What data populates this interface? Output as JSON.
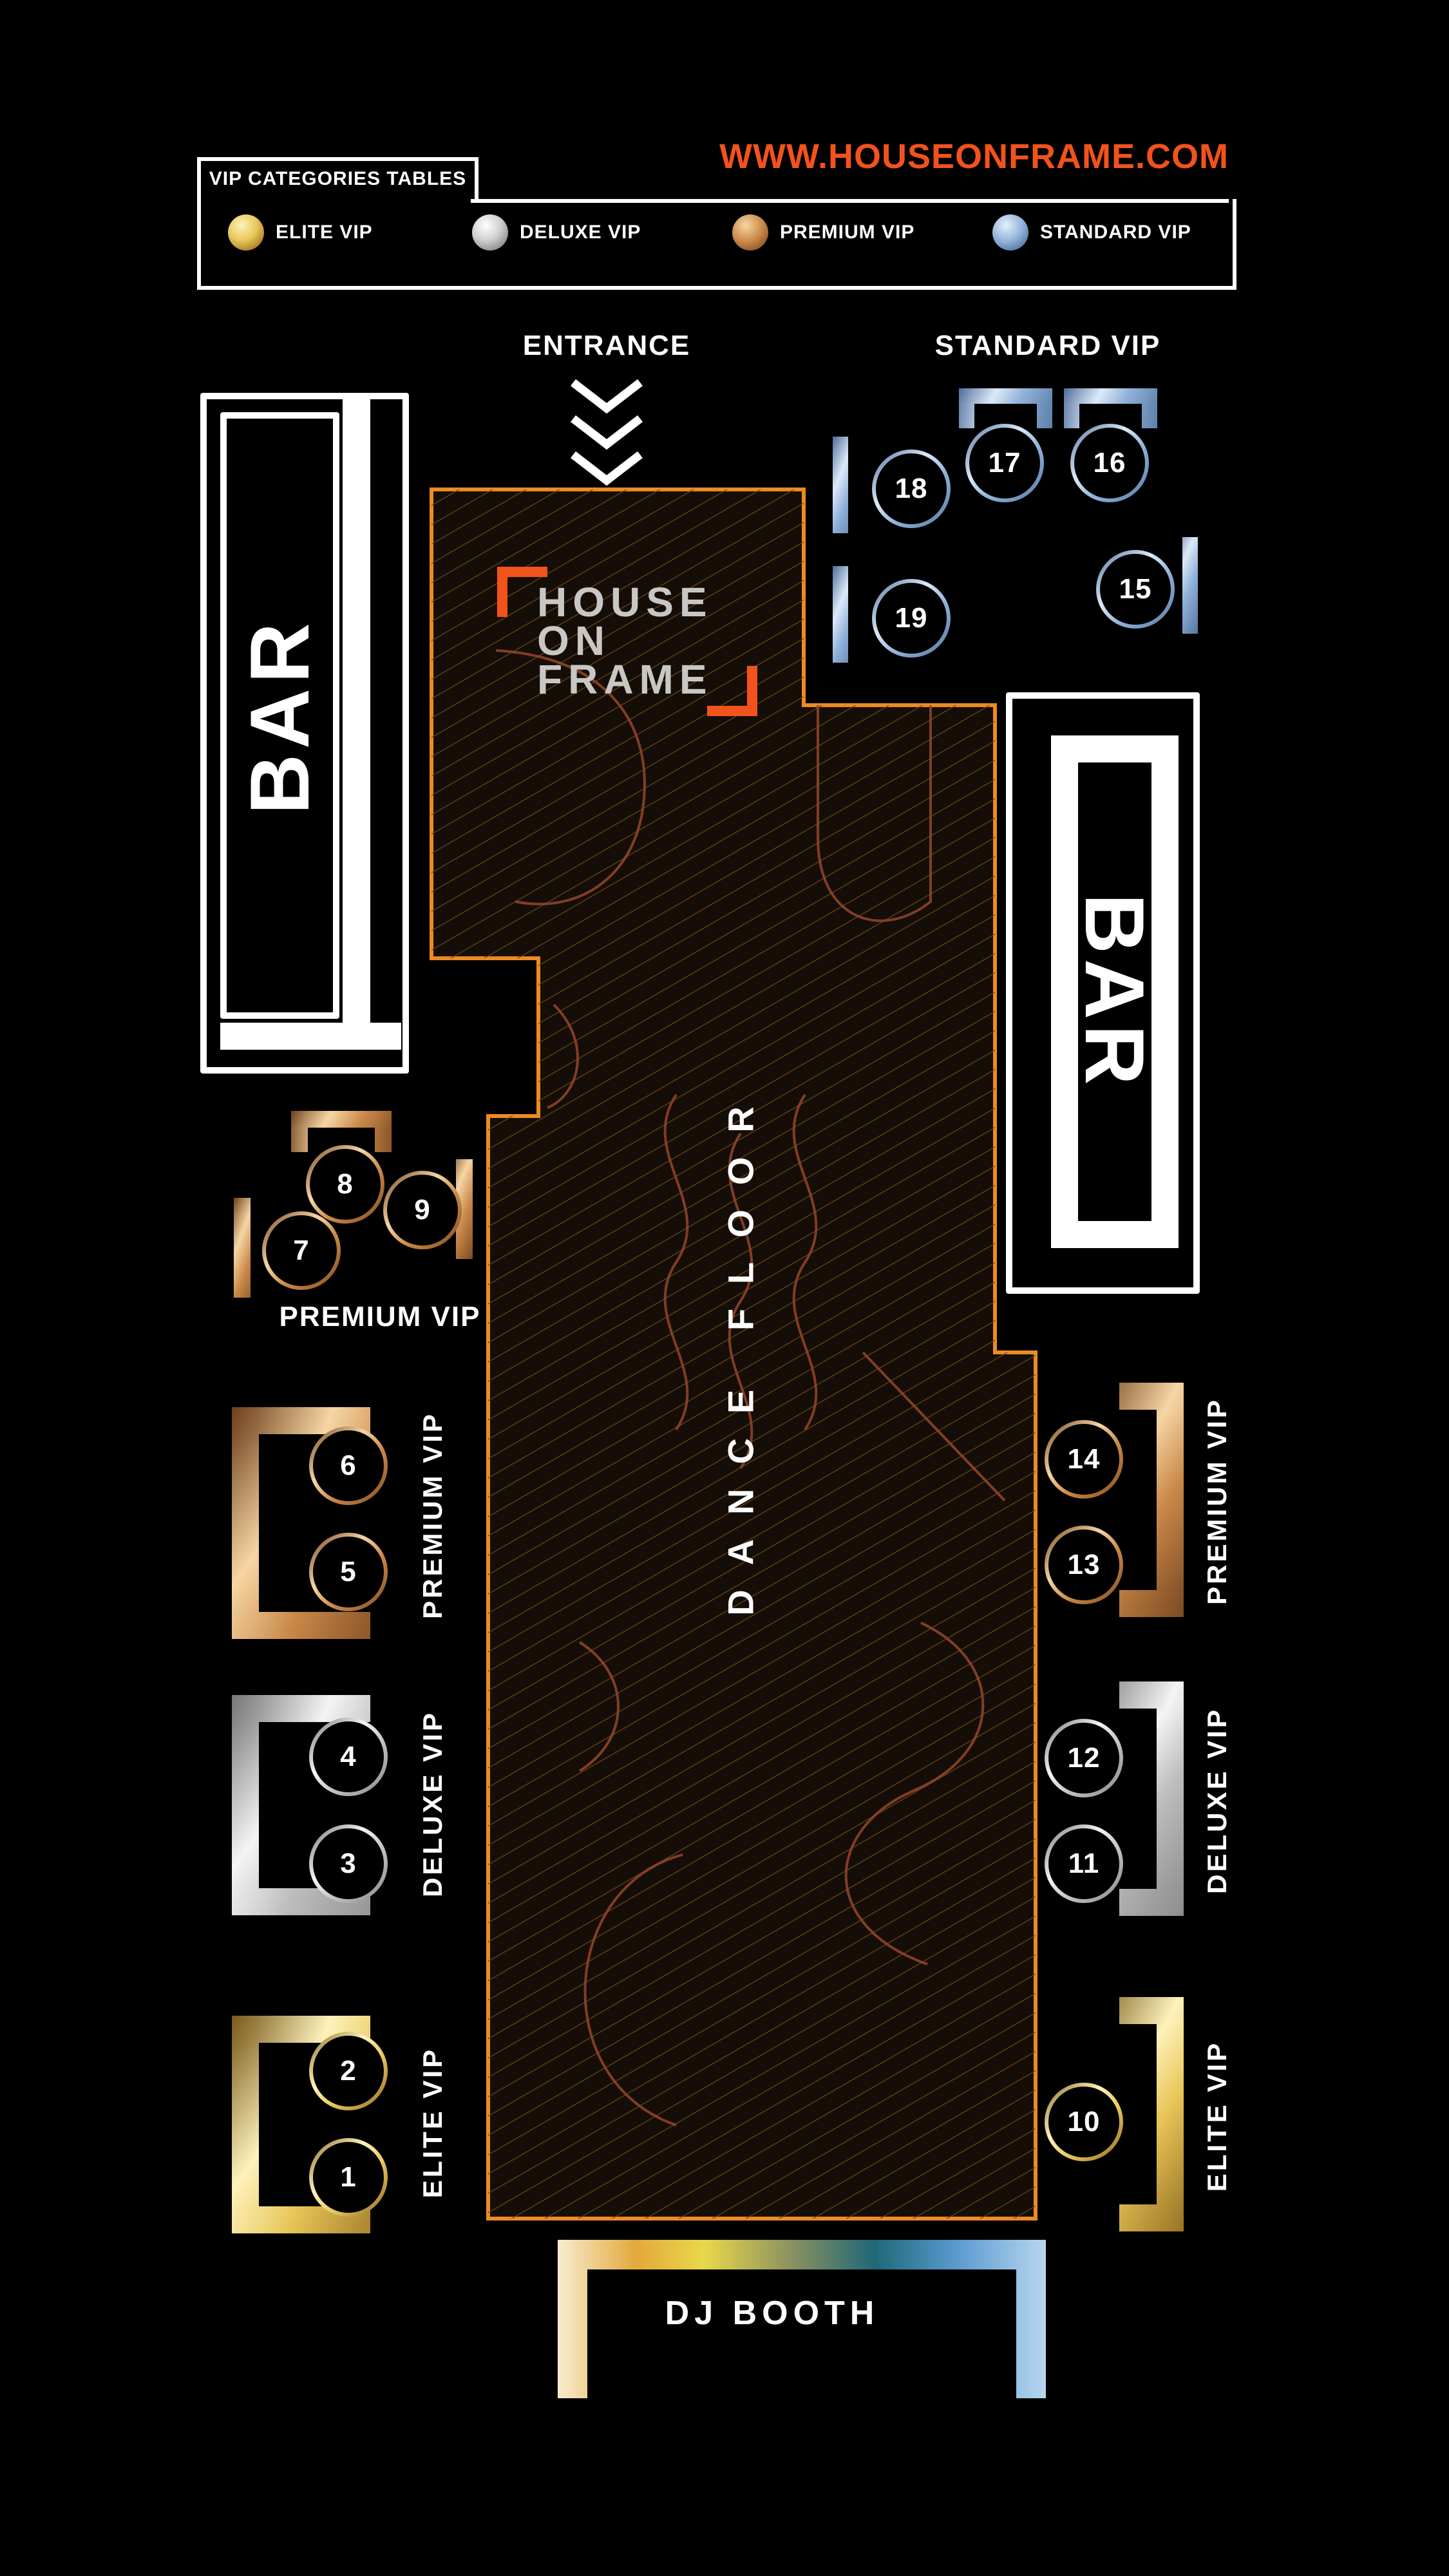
{
  "header": {
    "legend_title": "VIP CATEGORIES TABLES",
    "url": "WWW.HOUSEONFRAME.COM",
    "legend": [
      {
        "label": "ELITE VIP",
        "tier": "gold"
      },
      {
        "label": "DELUXE VIP",
        "tier": "silver"
      },
      {
        "label": "PREMIUM VIP",
        "tier": "bronze"
      },
      {
        "label": "STANDARD VIP",
        "tier": "blue"
      }
    ]
  },
  "areas": {
    "entrance_label": "ENTRANCE",
    "standard_vip_label": "STANDARD VIP",
    "premium_cluster_label": "PREMIUM VIP",
    "dance_floor_label": "DANCE FLOOR",
    "dj_booth_label": "DJ BOOTH",
    "bar_left_label": "BAR",
    "bar_right_label": "BAR",
    "logo_lines": [
      "HOUSE",
      "ON",
      "FRAME"
    ],
    "section_labels": {
      "premium_left": "PREMIUM VIP",
      "deluxe_left": "DELUXE VIP",
      "elite_left": "ELITE VIP",
      "premium_right": "PREMIUM VIP",
      "deluxe_right": "DELUXE VIP",
      "elite_right": "ELITE VIP"
    }
  },
  "tables": [
    {
      "number": "1",
      "tier": "elite"
    },
    {
      "number": "2",
      "tier": "elite"
    },
    {
      "number": "3",
      "tier": "deluxe"
    },
    {
      "number": "4",
      "tier": "deluxe"
    },
    {
      "number": "5",
      "tier": "premium"
    },
    {
      "number": "6",
      "tier": "premium"
    },
    {
      "number": "7",
      "tier": "premium"
    },
    {
      "number": "8",
      "tier": "premium"
    },
    {
      "number": "9",
      "tier": "premium"
    },
    {
      "number": "10",
      "tier": "elite"
    },
    {
      "number": "11",
      "tier": "deluxe"
    },
    {
      "number": "12",
      "tier": "deluxe"
    },
    {
      "number": "13",
      "tier": "premium"
    },
    {
      "number": "14",
      "tier": "premium"
    },
    {
      "number": "15",
      "tier": "standard"
    },
    {
      "number": "16",
      "tier": "standard"
    },
    {
      "number": "17",
      "tier": "standard"
    },
    {
      "number": "18",
      "tier": "standard"
    },
    {
      "number": "19",
      "tier": "standard"
    }
  ],
  "colors": {
    "accent_orange": "#F2521B",
    "floor_border_orange": "#ED8B23",
    "gold": "#E9C75A",
    "silver": "#C6C6C6",
    "bronze": "#C98848",
    "blue": "#8FB0D8",
    "logo_gray": "#C9C7C3"
  }
}
